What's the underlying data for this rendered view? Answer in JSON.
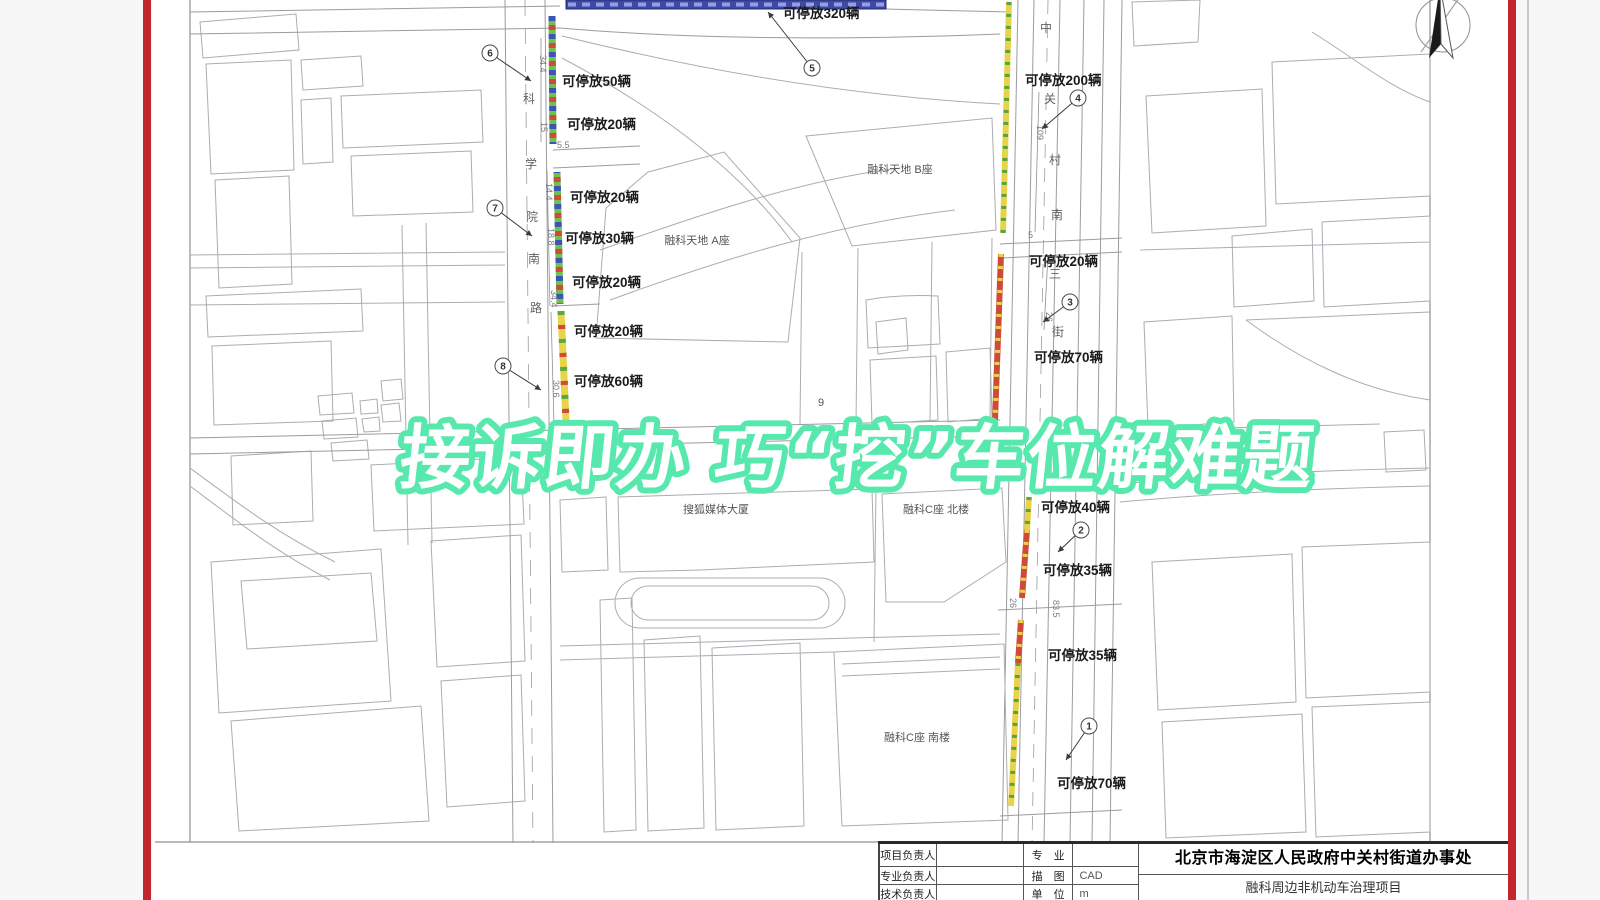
{
  "overlay": {
    "headline": "接诉即办 巧“挖”车位解难题",
    "headline_color": "#57e8ad"
  },
  "frame": {
    "border_color": "#c1272d"
  },
  "map": {
    "parking_labels": [
      {
        "text": "可停放320辆",
        "x": 783,
        "y": 18
      },
      {
        "text": "可停放50辆",
        "x": 562,
        "y": 86
      },
      {
        "text": "可停放20辆",
        "x": 567,
        "y": 129
      },
      {
        "text": "可停放20辆",
        "x": 570,
        "y": 202
      },
      {
        "text": "可停放30辆",
        "x": 565,
        "y": 243
      },
      {
        "text": "可停放20辆",
        "x": 572,
        "y": 287
      },
      {
        "text": "可停放20辆",
        "x": 574,
        "y": 336
      },
      {
        "text": "可停放60辆",
        "x": 574,
        "y": 386
      },
      {
        "text": "可停放200辆",
        "x": 1025,
        "y": 85
      },
      {
        "text": "可停放20辆",
        "x": 1029,
        "y": 266
      },
      {
        "text": "可停放70辆",
        "x": 1034,
        "y": 362
      },
      {
        "text": "可停放40辆",
        "x": 1041,
        "y": 512
      },
      {
        "text": "可停放35辆",
        "x": 1043,
        "y": 575
      },
      {
        "text": "可停放35辆",
        "x": 1048,
        "y": 660
      },
      {
        "text": "可停放70辆",
        "x": 1057,
        "y": 788
      }
    ],
    "markers": [
      {
        "n": "6",
        "cx": 490,
        "cy": 53,
        "tx": 531,
        "ty": 81
      },
      {
        "n": "7",
        "cx": 495,
        "cy": 208,
        "tx": 532,
        "ty": 236
      },
      {
        "n": "8",
        "cx": 503,
        "cy": 366,
        "tx": 541,
        "ty": 390
      },
      {
        "n": "5",
        "cx": 812,
        "cy": 68,
        "tx": 768,
        "ty": 12
      },
      {
        "n": "4",
        "cx": 1078,
        "cy": 98,
        "tx": 1042,
        "ty": 129
      },
      {
        "n": "3",
        "cx": 1070,
        "cy": 302,
        "tx": 1043,
        "ty": 322
      },
      {
        "n": "2",
        "cx": 1081,
        "cy": 530,
        "tx": 1058,
        "ty": 552
      },
      {
        "n": "1",
        "cx": 1089,
        "cy": 726,
        "tx": 1066,
        "ty": 760
      }
    ],
    "left_street_name": [
      {
        "ch": "科",
        "x": 529,
        "y": 103
      },
      {
        "ch": "学",
        "x": 531,
        "y": 168
      },
      {
        "ch": "院",
        "x": 532,
        "y": 221
      },
      {
        "ch": "南",
        "x": 534,
        "y": 263
      },
      {
        "ch": "路",
        "x": 536,
        "y": 312
      }
    ],
    "right_street_name": [
      {
        "ch": "中",
        "x": 1046,
        "y": 32
      },
      {
        "ch": "关",
        "x": 1050,
        "y": 103
      },
      {
        "ch": "村",
        "x": 1055,
        "y": 164
      },
      {
        "ch": "南",
        "x": 1057,
        "y": 219
      },
      {
        "ch": "三",
        "x": 1055,
        "y": 278
      },
      {
        "ch": "街",
        "x": 1058,
        "y": 336
      }
    ],
    "dimensions": [
      {
        "t": "34.4",
        "x": 540,
        "y": 55,
        "r": 90
      },
      {
        "t": "15",
        "x": 541,
        "y": 122,
        "r": 90
      },
      {
        "t": "5.5",
        "x": 557,
        "y": 148,
        "r": 0
      },
      {
        "t": "14.4",
        "x": 546,
        "y": 183,
        "r": 90
      },
      {
        "t": "18.8",
        "x": 548,
        "y": 228,
        "r": 90
      },
      {
        "t": "34.4",
        "x": 551,
        "y": 290,
        "r": 90
      },
      {
        "t": "30.6",
        "x": 553,
        "y": 380,
        "r": 90
      },
      {
        "t": "109",
        "x": 1037,
        "y": 125,
        "r": 90
      },
      {
        "t": "5",
        "x": 1028,
        "y": 238,
        "r": 0
      },
      {
        "t": "26",
        "x": 1046,
        "y": 312,
        "r": 90
      },
      {
        "t": "26",
        "x": 1010,
        "y": 598,
        "r": 90
      },
      {
        "t": "83.5",
        "x": 1053,
        "y": 600,
        "r": 90
      }
    ],
    "buildings": [
      {
        "t": "融科天地 B座",
        "x": 900,
        "y": 173
      },
      {
        "t": "融科天地 A座",
        "x": 697,
        "y": 244
      },
      {
        "t": "搜狐媒体大厦",
        "x": 716,
        "y": 513
      },
      {
        "t": "融科C座 北楼",
        "x": 936,
        "y": 513
      },
      {
        "t": "融科C座 南楼",
        "x": 917,
        "y": 741
      },
      {
        "t": "9",
        "x": 821,
        "y": 406
      }
    ]
  },
  "title_block": {
    "col1": [
      "项目负责人",
      "专业负责人",
      "技术负责人"
    ],
    "col3": [
      "专　业",
      "描　图",
      "单　位"
    ],
    "col4": [
      "",
      "CAD",
      "m"
    ],
    "org": "北京市海淀区人民政府中关村街道办事处",
    "project": "融科周边非机动车治理项目"
  }
}
